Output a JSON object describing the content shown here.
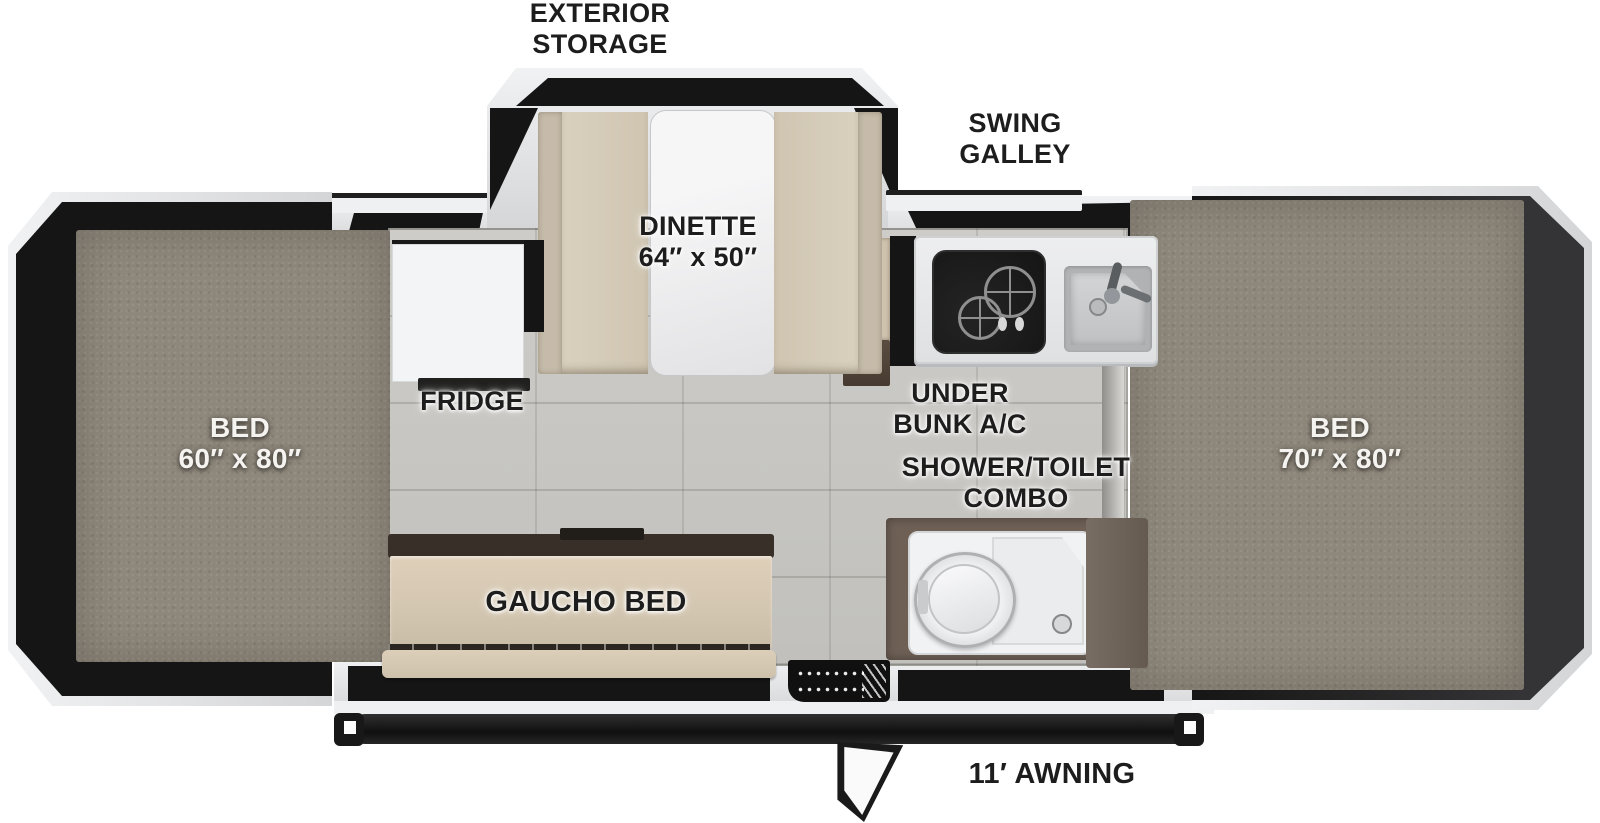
{
  "page": {
    "title": "Pop-up camper floor plan (top view)",
    "canvas_width": 1600,
    "canvas_height": 823
  },
  "labels": {
    "exterior_storage": "EXTERIOR\nSTORAGE",
    "swing_galley": "SWING\nGALLEY",
    "dinette": "DINETTE\n64″ x 50″",
    "fridge": "FRIDGE",
    "under_bunk_ac": "UNDER\nBUNK A/C",
    "shower_toilet_combo": "SHOWER/TOILET\nCOMBO",
    "gaucho_bed": "GAUCHO BED",
    "awning": "11′ AWNING",
    "bed_left": "BED\n60″ x 80″",
    "bed_right": "BED\n70″ x 80″"
  },
  "colors": {
    "background": "#ffffff",
    "shell_light": "#f1f2f3",
    "shell_dark": "#d4d5d7",
    "tent_black": "#151515",
    "tent_gray": "#343436",
    "mattress_taupe": "#8e877b",
    "floor_tile": "#c9c8c4",
    "cushion_tan": "#d7cdba",
    "cushion_back_tan": "#c6bbaa",
    "table_white": "#f2f2f3",
    "counter_white": "#e9eaec",
    "stove_black": "#1b1b1b",
    "sink_gray": "#b0b2b4",
    "cabinet_brown": "#6e6055",
    "gaucho_tan": "#d5c8b2",
    "gaucho_rail_brown": "#372f28",
    "awning_black": "#1c1c1c",
    "label_black": "#1d1d1d",
    "label_white": "#f4f3f0"
  }
}
